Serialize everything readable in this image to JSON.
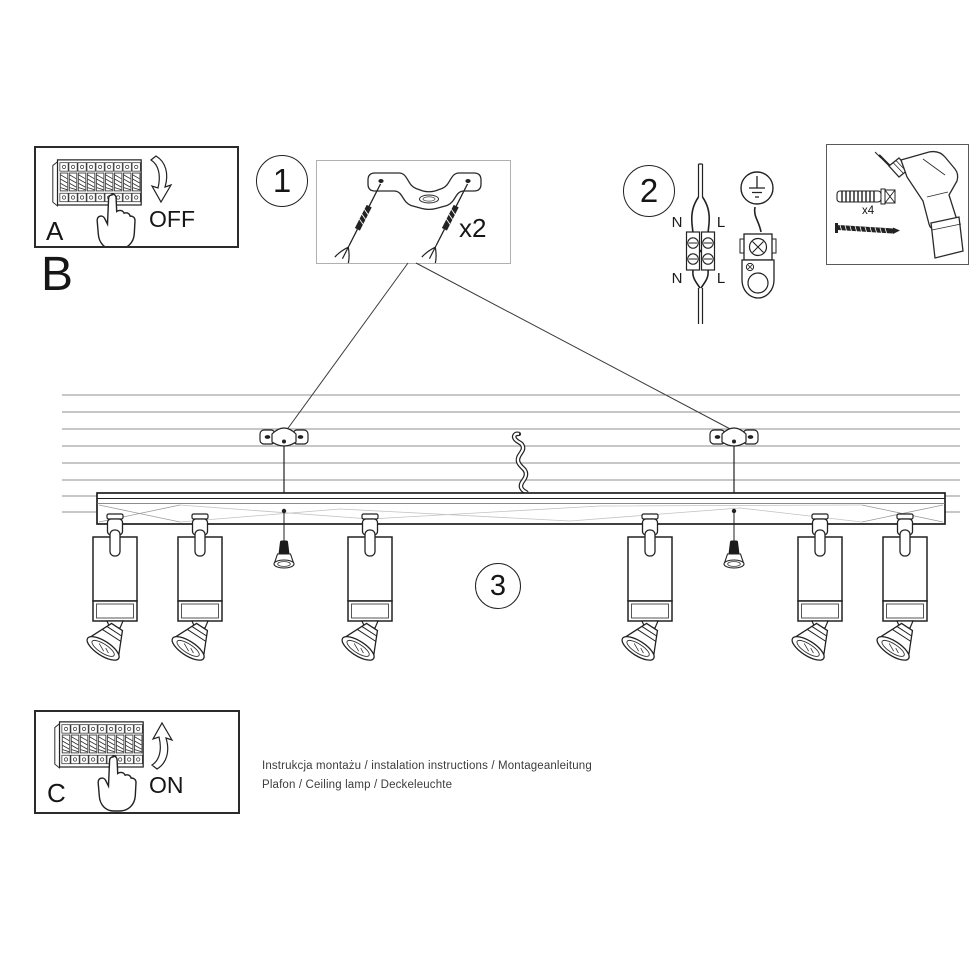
{
  "panels": {
    "a": {
      "label": "A",
      "action": "OFF"
    },
    "b": {
      "label": "B"
    },
    "c": {
      "label": "C",
      "action": "ON"
    }
  },
  "steps": {
    "one": "1",
    "two": "2",
    "three": "3"
  },
  "quantities": {
    "mounting_kit": "x2",
    "screw_kit": "x4"
  },
  "wiring": {
    "n_top": "N",
    "l_top": "L",
    "n_bottom": "N",
    "l_bottom": "L"
  },
  "footer": {
    "line1": "Instrukcja montażu / instalation instructions / Montageanleitung",
    "line2": "Plafon / Ceiling lamp / Deckeleuchte"
  },
  "colors": {
    "ink": "#1e1e1e",
    "ceiling_line": "#8f8f8f"
  }
}
